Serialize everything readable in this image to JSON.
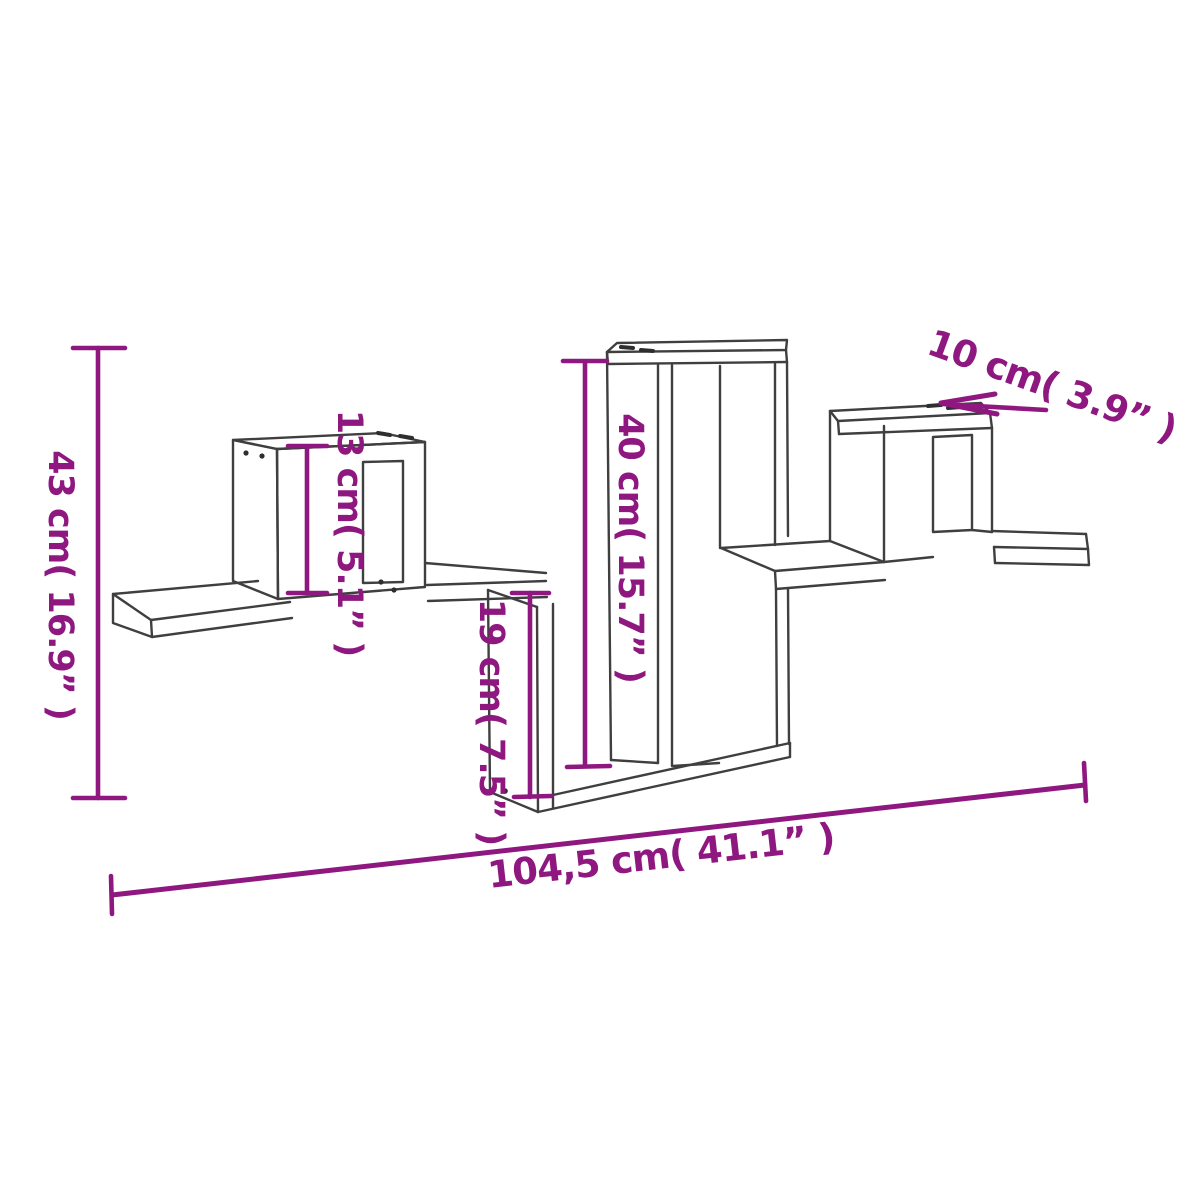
{
  "title": "Wall shelf dimension diagram",
  "colors": {
    "background": "#ffffff",
    "line_art": "#3f3f40",
    "dimension_accent": "#8e1880"
  },
  "dimensions": {
    "total_height": {
      "label": "43 cm( 16.9” )",
      "value_cm": "43",
      "value_inch": "16.9"
    },
    "cube_height": {
      "label": "13 cm( 5.1” )",
      "value_cm": "13",
      "value_inch": "5.1"
    },
    "inner_height": {
      "label": "40 cm( 15.7” )",
      "value_cm": "40",
      "value_inch": "15.7"
    },
    "drop_height": {
      "label": "19 cm( 7.5” )",
      "value_cm": "19",
      "value_inch": "7.5"
    },
    "depth": {
      "label": "10 cm( 3.9” )",
      "value_cm": "10",
      "value_inch": "3.9"
    },
    "total_width": {
      "label": "104,5 cm( 41.1” )",
      "value_cm": "104,5",
      "value_inch": "41.1"
    }
  }
}
